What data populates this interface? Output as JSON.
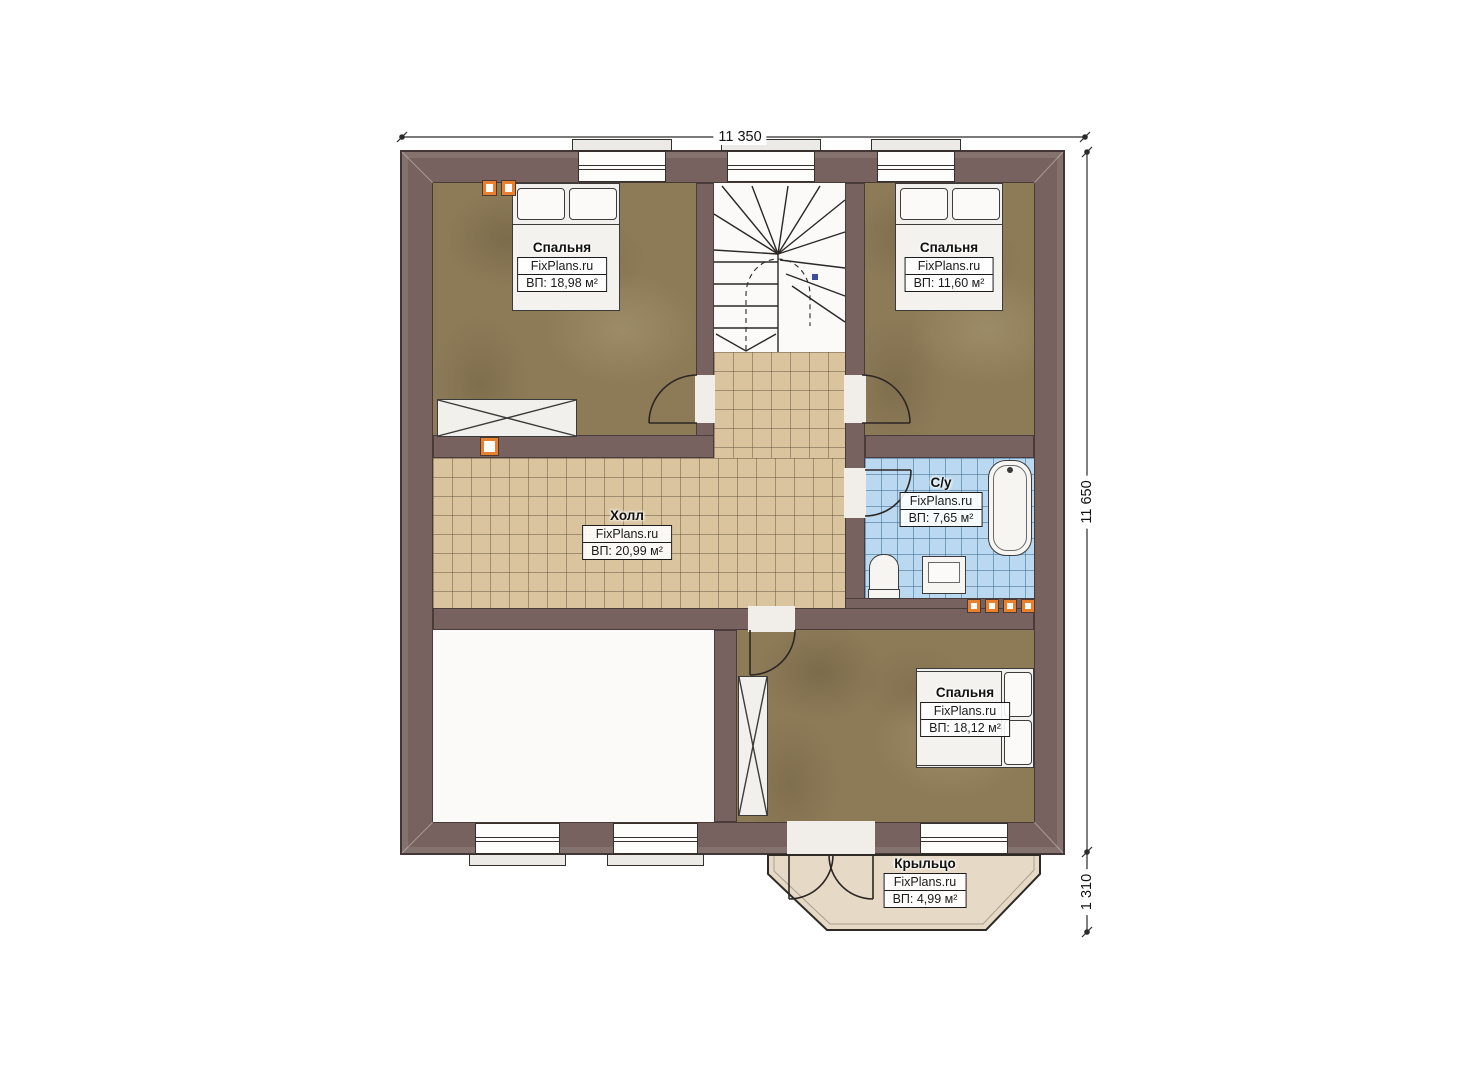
{
  "plan": {
    "site": "FixPlans.ru",
    "dims": {
      "width_top": "11 350",
      "height_right": "11 650",
      "porch_right": "1 310"
    },
    "rooms": [
      {
        "name": "Спальня",
        "area": "ВП: 18,98 м²"
      },
      {
        "name": "Спальня",
        "area": "ВП: 11,60 м²"
      },
      {
        "name": "Холл",
        "area": "ВП: 20,99 м²"
      },
      {
        "name": "С/у",
        "area": "ВП: 7,65 м²"
      },
      {
        "name": "Спальня",
        "area": "ВП: 18,12 м²"
      },
      {
        "name": "Крыльцо",
        "area": "ВП: 4,99 м²"
      }
    ],
    "colors": {
      "wall": "#77625f",
      "bedroom_floor": "#8d7b58",
      "hall_floor": "#d9c49d",
      "bath_floor": "#bad9f0",
      "porch_floor": "#e6d9c6",
      "vent_accent": "#e8802e"
    }
  }
}
